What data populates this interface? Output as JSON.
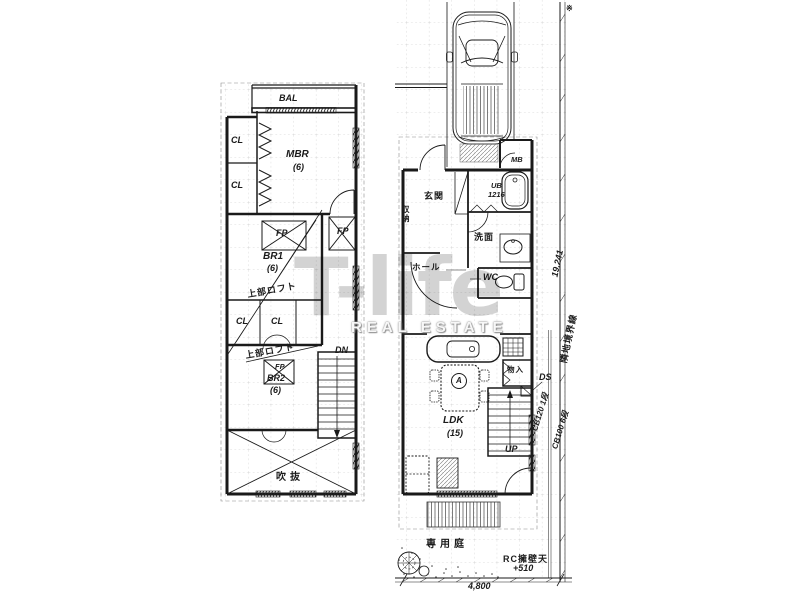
{
  "watermark": {
    "logo": "T-life",
    "subtitle": "REAL ESTATE"
  },
  "floor2": {
    "bal": "BAL",
    "cl": [
      "CL",
      "CL",
      "CL",
      "CL"
    ],
    "mbr": "MBR",
    "mbr_area": "(6)",
    "fp": [
      "FP",
      "FP",
      "FP"
    ],
    "br1": "BR1",
    "br1_area": "(6)",
    "loft_upper": "上部ロフト",
    "loft_lower": "上部ロフト",
    "br2": "BR2",
    "br2_area": "(6)",
    "dn": "DN",
    "void": "吹抜"
  },
  "floor1": {
    "entrance": "玄関",
    "storage": "収納",
    "mb": "MB",
    "ub": "UB",
    "ub_size": "1216",
    "washroom": "洗面",
    "hall": "ホール",
    "wc": "WC",
    "closet": "物入",
    "ds": "DS",
    "ldk": "LDK",
    "ldk_area": "(15)",
    "up": "UP",
    "table_mark": "A",
    "cb_wall_a": "CB120 1段",
    "cb_wall_b": "CB100 6段",
    "garden": "専用庭",
    "retaining_wall": "RC擁壁天",
    "retaining_level": "+510",
    "dim_width": "4,800",
    "boundary_label": "隣地境界線",
    "boundary_length": "19.241",
    "ref_mark": "※"
  }
}
